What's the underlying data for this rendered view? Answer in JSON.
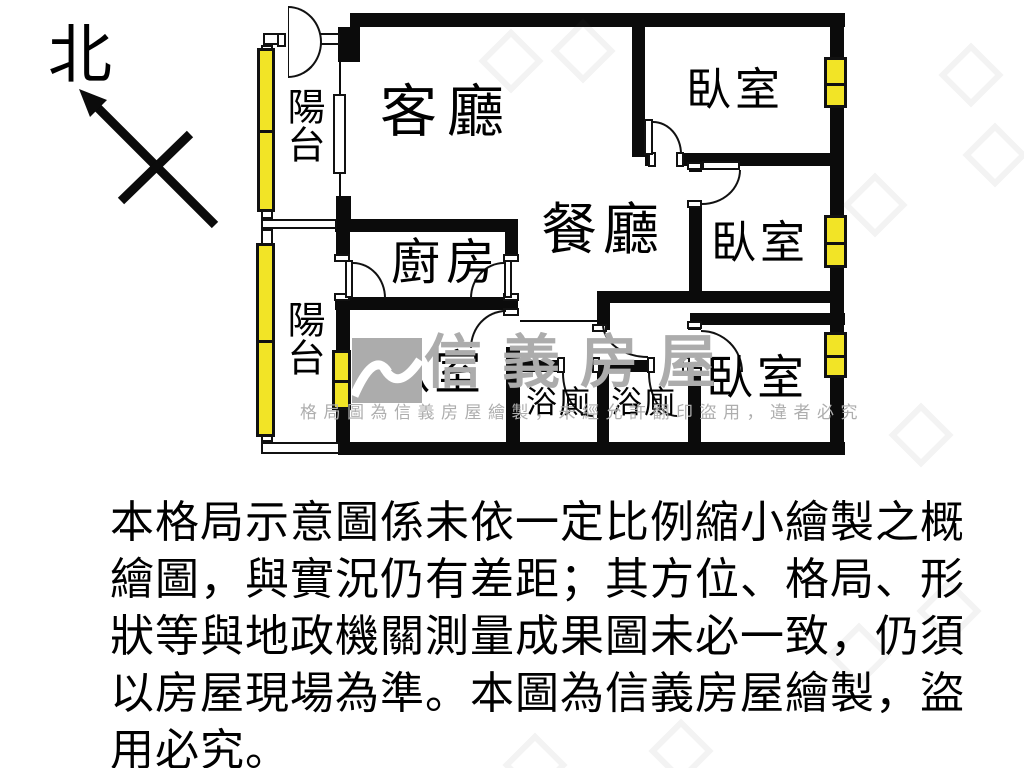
{
  "meta": {
    "type": "apartment-floor-plan",
    "brand": "信義房屋"
  },
  "north": {
    "label": "北"
  },
  "rooms": {
    "living": "客廳",
    "dining": "餐廳",
    "kitchen": "廚房",
    "bedroom_top_right": "臥室",
    "bedroom_mid_right": "臥室",
    "bedroom_bottom_right": "臥室",
    "bedroom_bottom_left": "臥室",
    "balcony_upper": "陽台",
    "balcony_lower": "陽台",
    "bath_left": "浴廁",
    "bath_right": "浴廁"
  },
  "watermark": {
    "brand": "信義房屋",
    "notice": "格局圖為信義房屋繪製，未經允許翻印盜用，違者必究"
  },
  "disclaimer": {
    "line1": "本格局示意圖係未依一定比例縮小繪製之概",
    "line2": "繪圖，與實況仍有差距；其方位、格局、形",
    "line3": "狀等與地政機關測量成果圖未必一致，仍須",
    "line4": "以房屋現場為準。本圖為信義房屋繪製，盜",
    "line5": "用必究。"
  },
  "colors": {
    "wall": "#0B0B0B",
    "window_yellow": "#F2E426",
    "watermark_grey": "#ACACAC",
    "background": "#FFFFFF"
  }
}
